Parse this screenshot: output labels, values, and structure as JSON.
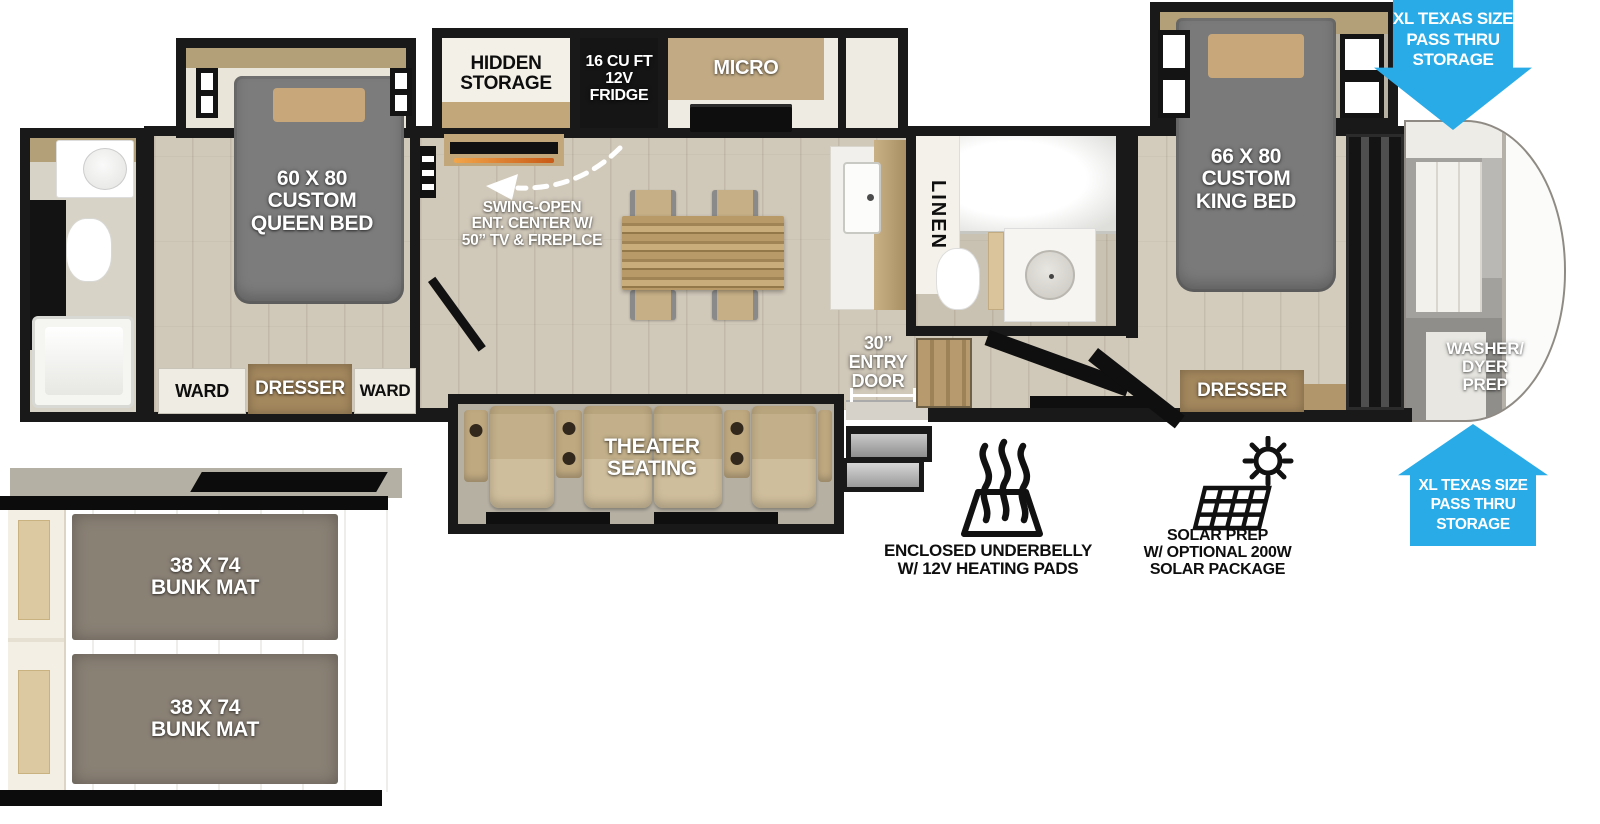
{
  "plan": {
    "queen_room": {
      "bed": "60 X 80\nCUSTOM\nQUEEN BED",
      "ward_left": "WARD",
      "dresser": "DRESSER",
      "ward_right": "WARD"
    },
    "kitchen": {
      "hidden_storage": "HIDDEN\nSTORAGE",
      "fridge": "16 CU FT\n12V\nFRIDGE",
      "micro": "MICRO",
      "ent_center": "SWING-OPEN\nENT. CENTER W/\n50” TV & FIREPLCE"
    },
    "living": {
      "theater": "THEATER\nSEATING",
      "entry_door": "30”\nENTRY\nDOOR"
    },
    "mid_bath": {
      "linen": "LINEN"
    },
    "king_room": {
      "bed": "66 X 80\nCUSTOM\nKING BED",
      "dresser": "DRESSER",
      "washer_prep": "WASHER/\nDYER\nPREP"
    },
    "pass_thru_front": "XL TEXAS SIZE\nPASS THRU\nSTORAGE",
    "pass_thru_rear": "XL TEXAS SIZE\nPASS THRU\nSTORAGE"
  },
  "features": {
    "underbelly": "ENCLOSED UNDERBELLY\nW/ 12V HEATING PADS",
    "solar": "SOLAR PREP\nW/ OPTIONAL 200W\nSOLAR PACKAGE"
  },
  "bunk_inset": {
    "upper_mat": "38 X 74\nBUNK MAT",
    "lower_mat": "38 X 74\nBUNK MAT"
  },
  "colors": {
    "arrow_blue": "#29abe8",
    "wall_black": "#191919",
    "floor_wood": "#d0c8b9",
    "bed_gray": "#7c7c7c",
    "pillow_tan": "#c8a87a",
    "cabinet_tan": "#a3875d",
    "theater_seat_tan": "#c3b08a",
    "bunk_mat_gray": "#8a8175"
  }
}
